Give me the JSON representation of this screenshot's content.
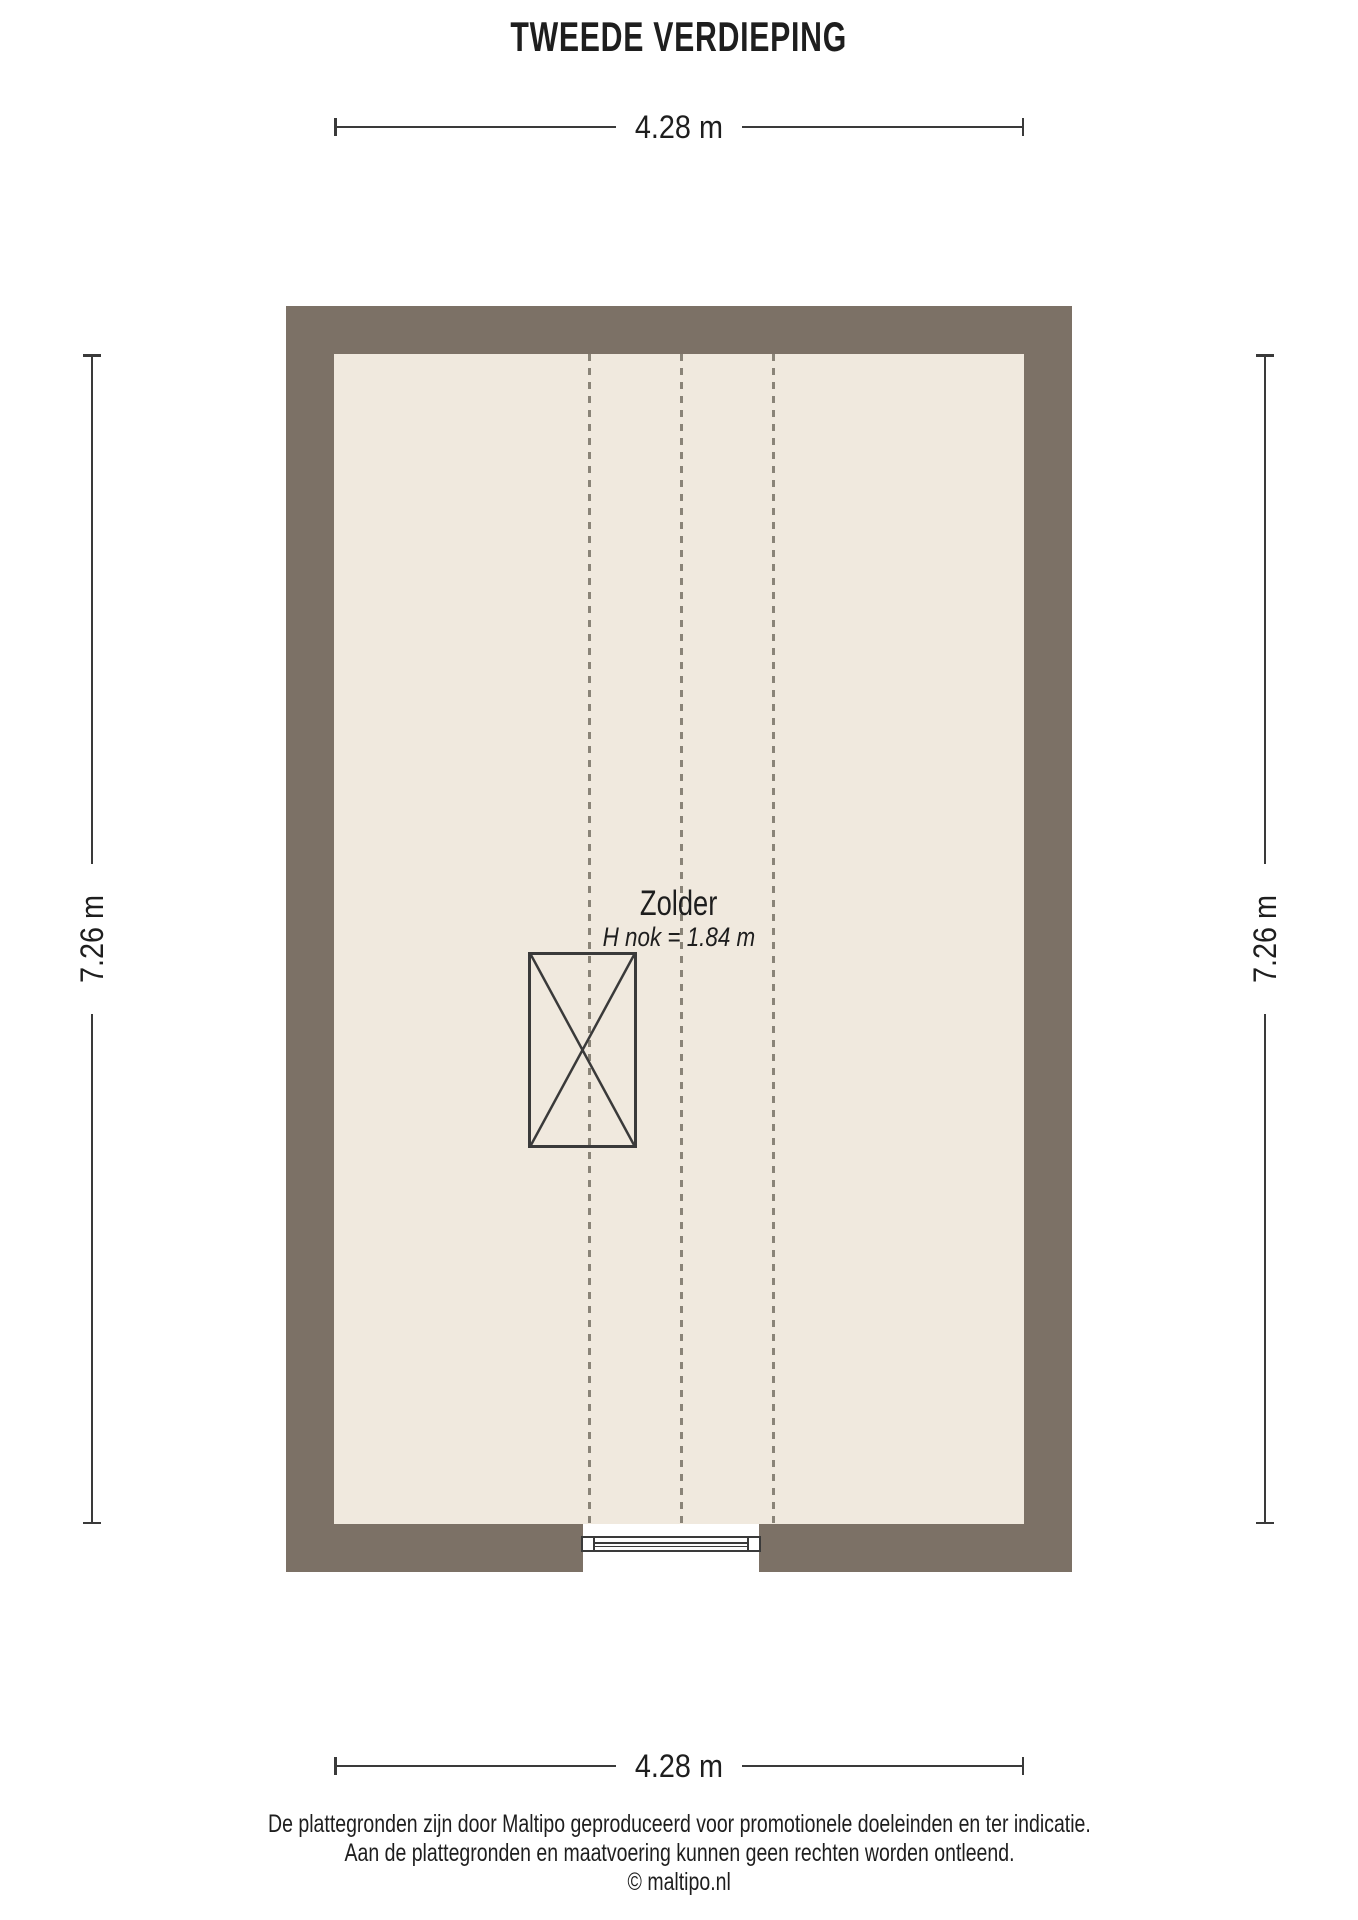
{
  "title": "TWEEDE VERDIEPING",
  "floorplan": {
    "room": {
      "name": "Zolder",
      "height_note": "H nok = 1.84 m"
    },
    "dimensions": {
      "width_top": "4.28 m",
      "width_bottom": "4.28 m",
      "height_left": "7.26 m",
      "height_right": "7.26 m"
    },
    "colors": {
      "wall": "#7c7166",
      "floor": "#f0e9de",
      "outline": "#3a3a3a",
      "roof_line": "#8a8478"
    }
  },
  "footer": {
    "disclaimer_line1": "De plattegronden zijn door Maltipo geproduceerd voor promotionele doeleinden en ter indicatie.",
    "disclaimer_line2": "Aan de plattegronden en maatvoering kunnen geen rechten worden ontleend.",
    "copyright": "© maltipo.nl"
  }
}
